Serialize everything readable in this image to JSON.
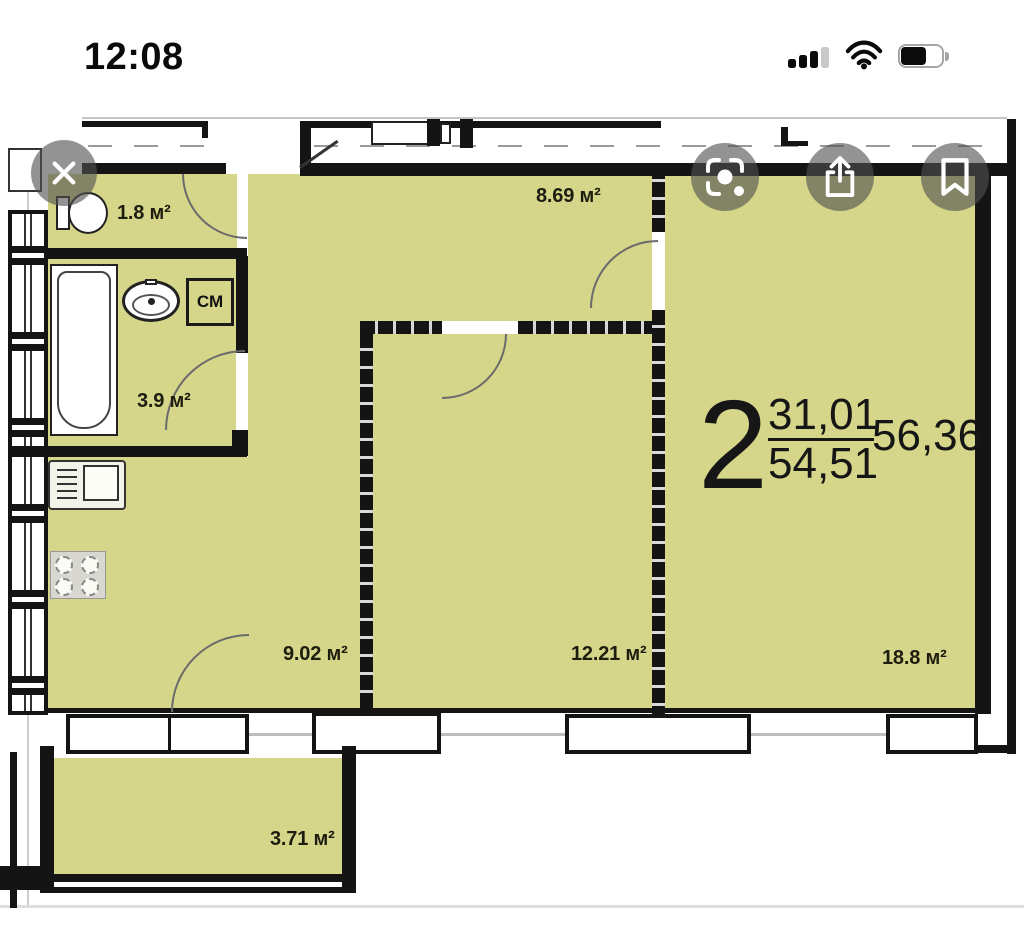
{
  "status_bar": {
    "time": "12:08",
    "battery_level_percent": 60,
    "signal_bars_filled": 3,
    "signal_bars_total": 4,
    "icons": {
      "cellular": "signal-bars",
      "wifi": "wifi-arcs",
      "battery": "battery-body"
    }
  },
  "viewer_toolbar": {
    "icons": {
      "close": "x-cross",
      "visual_lookup": "viewfinder-with-dot",
      "share": "square-with-up-arrow",
      "bookmark": "bookmark-ribbon-outline"
    }
  },
  "floor_plan": {
    "unit": {
      "room_count": "2",
      "living_area": "31,01",
      "total_area": "54,51",
      "overall_area": "56,36"
    },
    "rooms": [
      {
        "id": "toilet",
        "area": "1.8 м²"
      },
      {
        "id": "hallway",
        "area": "8.69 м²"
      },
      {
        "id": "bathroom",
        "area": "3.9 м²"
      },
      {
        "id": "kitchen",
        "area": "9.02 м²"
      },
      {
        "id": "bedroom",
        "area": "12.21 м²"
      },
      {
        "id": "living-room",
        "area": "18.8 м²"
      },
      {
        "id": "balcony",
        "area": "3.71 м²"
      }
    ],
    "fixtures": {
      "washing_machine_label": "СМ"
    },
    "colors": {
      "room_fill": "#d6d68a",
      "wall": "#141414"
    }
  }
}
